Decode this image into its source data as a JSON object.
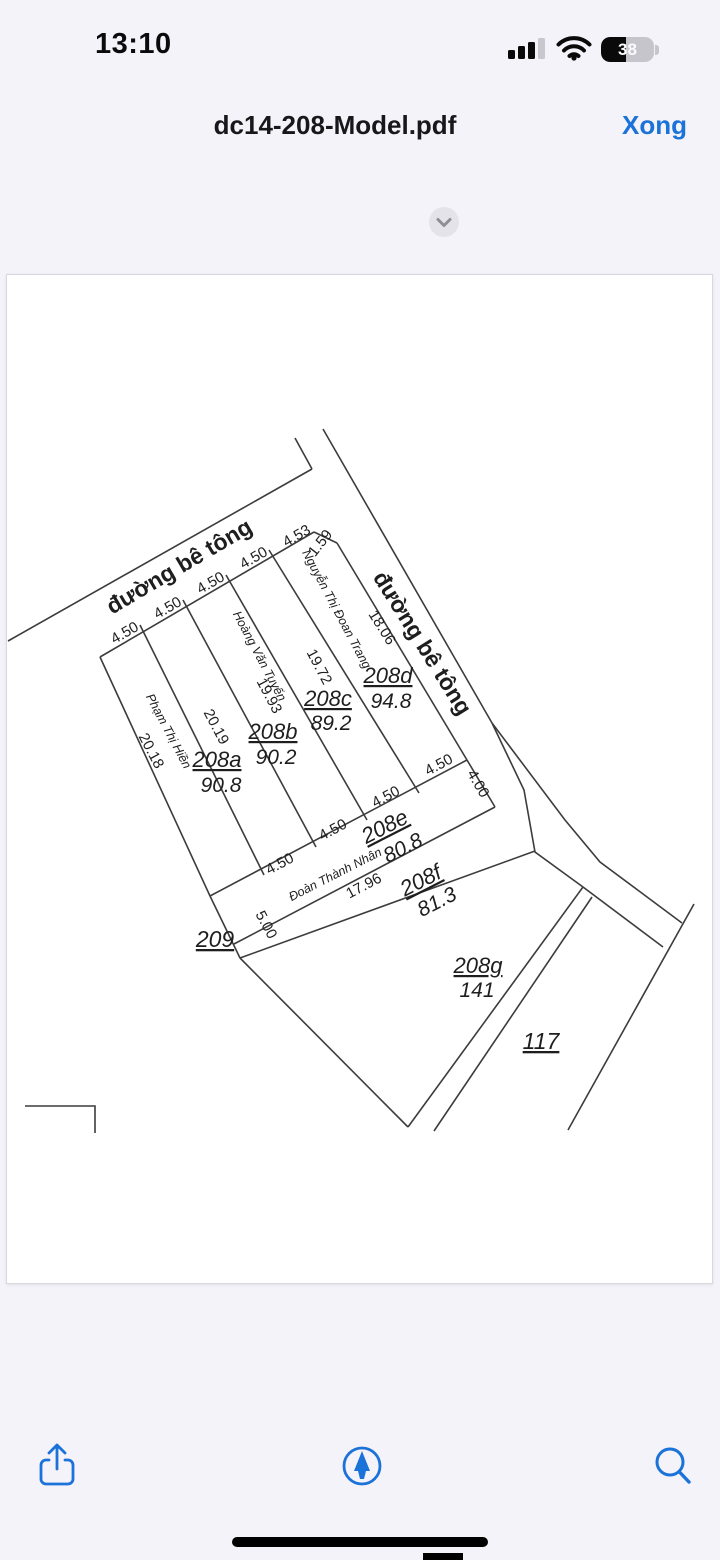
{
  "status_bar": {
    "time": "13:10",
    "battery_level": "38"
  },
  "nav_bar": {
    "filename": "dc14-208-Model.pdf",
    "done_button": "Xong"
  },
  "colors": {
    "accent_blue": "#1B72D9",
    "line_color": "#3C3C3C",
    "app_bg": "#F4F3F9"
  },
  "drawing": {
    "road_labels": {
      "top": "đường bê tông",
      "right": "đường bê tông"
    },
    "plots": [
      {
        "id": "208a",
        "area": "90.8",
        "owner": "Phạm Thị Hiền"
      },
      {
        "id": "208b",
        "area": "90.2",
        "owner": ""
      },
      {
        "id": "208c",
        "area": "89.2",
        "owner": "Hoàng Văn Tuyến"
      },
      {
        "id": "208d",
        "area": "94.8",
        "owner": "Nguyễn Thị Đoan Trang"
      },
      {
        "id": "208e",
        "area": "80.8",
        "owner": "Đoàn Thành Nhân"
      },
      {
        "id": "208f",
        "area": "81.3",
        "owner": ""
      },
      {
        "id": "208g",
        "area": "141",
        "owner": ""
      },
      {
        "id": "209",
        "area": "",
        "owner": ""
      },
      {
        "id": "117",
        "area": "",
        "owner": ""
      }
    ],
    "measurements": {
      "frontage": [
        "4.50",
        "4.50",
        "4.50",
        "4.50",
        "4.53",
        "1.59"
      ],
      "depths": [
        "20.18",
        "20.19",
        "19.93",
        "19.72",
        "18.06"
      ],
      "rear": [
        "4.50",
        "4.50",
        "4.50",
        "4.50",
        "4.00"
      ],
      "band": [
        "5.00",
        "17.96"
      ]
    }
  },
  "toolbar": {
    "icons": [
      "share-icon",
      "markup-icon",
      "search-icon"
    ]
  }
}
